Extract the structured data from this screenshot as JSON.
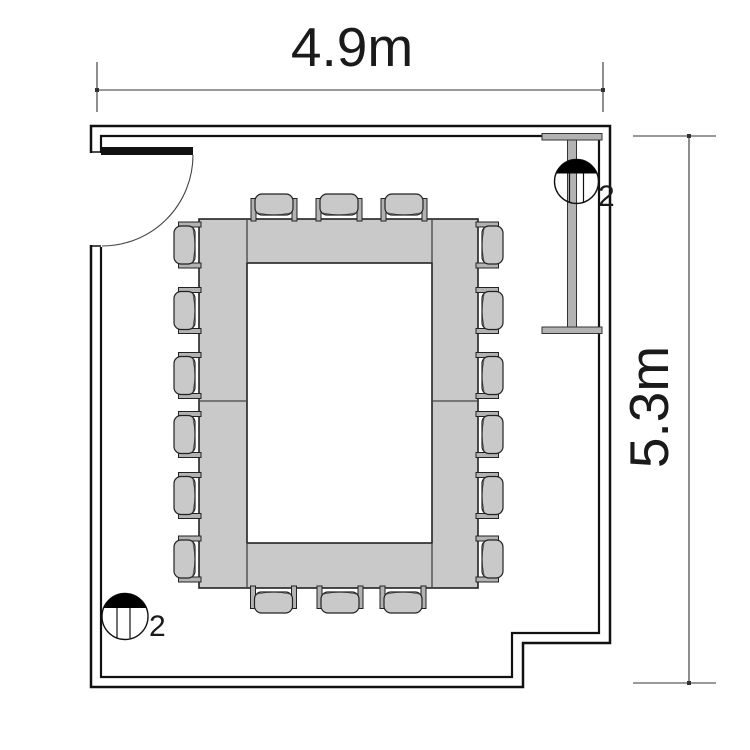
{
  "plan": {
    "width_dimension": "4.9m",
    "height_dimension": "5.3m",
    "outlet_top_right": {
      "count": "2",
      "position": "top-right"
    },
    "outlet_bottom_left": {
      "count": "2",
      "position": "bottom-left"
    },
    "seat_count": 18,
    "chairs_per_side": {
      "top": 3,
      "right": 6,
      "bottom": 3,
      "left": 6
    },
    "table_layout": "closed hollow-rectangle boardroom table",
    "features": [
      "hinged door at top-left",
      "wall-mounted screen rail on right wall",
      "recessed corner at bottom-right"
    ],
    "colors": {
      "furniture_gray": "#c9c9c9",
      "rail_gray": "#b3b3b3",
      "line": "#111111",
      "dim": "#333333"
    }
  }
}
